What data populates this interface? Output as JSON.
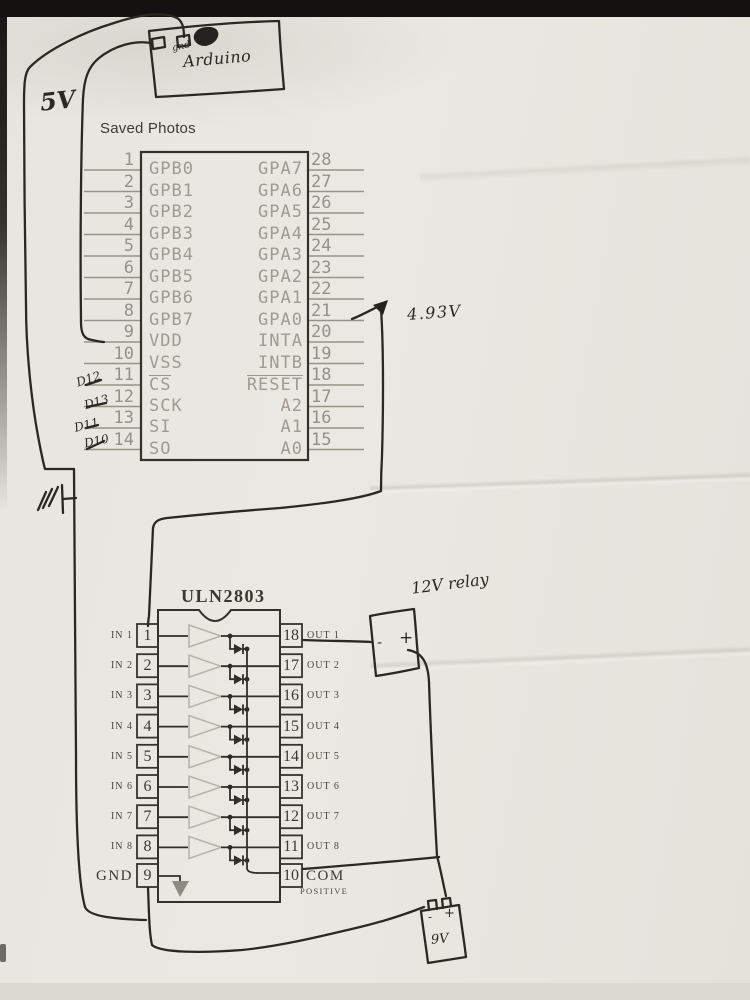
{
  "overlay": {
    "saved_photos": "Saved Photos"
  },
  "handwritten": {
    "supply": "5V",
    "board": "Arduino",
    "board_pin": "gnd",
    "voltage": "4.93V",
    "relay": "12V relay",
    "battery": "9V",
    "relay_minus": "-",
    "relay_plus": "+",
    "battery_minus": "-",
    "battery_plus": "+",
    "dpins": [
      "D12",
      "D13",
      "D11",
      "D10"
    ]
  },
  "mcp": {
    "left_pins": [
      {
        "num": "1",
        "label": "GPB0"
      },
      {
        "num": "2",
        "label": "GPB1"
      },
      {
        "num": "3",
        "label": "GPB2"
      },
      {
        "num": "4",
        "label": "GPB3"
      },
      {
        "num": "5",
        "label": "GPB4"
      },
      {
        "num": "6",
        "label": "GPB5"
      },
      {
        "num": "7",
        "label": "GPB6"
      },
      {
        "num": "8",
        "label": "GPB7"
      },
      {
        "num": "9",
        "label": "VDD"
      },
      {
        "num": "10",
        "label": "VSS"
      },
      {
        "num": "11",
        "label": "CS",
        "overline": true
      },
      {
        "num": "12",
        "label": "SCK"
      },
      {
        "num": "13",
        "label": "SI"
      },
      {
        "num": "14",
        "label": "SO"
      }
    ],
    "right_pins": [
      {
        "num": "28",
        "label": "GPA7"
      },
      {
        "num": "27",
        "label": "GPA6"
      },
      {
        "num": "26",
        "label": "GPA5"
      },
      {
        "num": "25",
        "label": "GPA4"
      },
      {
        "num": "24",
        "label": "GPA3"
      },
      {
        "num": "23",
        "label": "GPA2"
      },
      {
        "num": "22",
        "label": "GPA1"
      },
      {
        "num": "21",
        "label": "GPA0"
      },
      {
        "num": "20",
        "label": "INTA"
      },
      {
        "num": "19",
        "label": "INTB"
      },
      {
        "num": "18",
        "label": "RESET",
        "overline": true
      },
      {
        "num": "17",
        "label": "A2"
      },
      {
        "num": "16",
        "label": "A1"
      },
      {
        "num": "15",
        "label": "A0"
      }
    ]
  },
  "uln": {
    "title": "ULN2803",
    "left_pins": [
      {
        "num": "1",
        "label": "IN 1"
      },
      {
        "num": "2",
        "label": "IN 2"
      },
      {
        "num": "3",
        "label": "IN 3"
      },
      {
        "num": "4",
        "label": "IN 4"
      },
      {
        "num": "5",
        "label": "IN 5"
      },
      {
        "num": "6",
        "label": "IN 6"
      },
      {
        "num": "7",
        "label": "IN 7"
      },
      {
        "num": "8",
        "label": "IN 8"
      },
      {
        "num": "9",
        "label": "GND"
      }
    ],
    "right_pins": [
      {
        "num": "18",
        "label": "OUT 1"
      },
      {
        "num": "17",
        "label": "OUT 2"
      },
      {
        "num": "16",
        "label": "OUT 3"
      },
      {
        "num": "15",
        "label": "OUT 4"
      },
      {
        "num": "14",
        "label": "OUT 5"
      },
      {
        "num": "13",
        "label": "OUT 6"
      },
      {
        "num": "12",
        "label": "OUT 7"
      },
      {
        "num": "11",
        "label": "OUT 8"
      },
      {
        "num": "10",
        "label": "COM",
        "sublabel": "POSITIVE"
      }
    ]
  },
  "colors": {
    "ink": "#2b2823",
    "print_grey": "#9f9b92",
    "print_dark": "#3c3933",
    "paper": "#e9e6e1",
    "scan_bar": "#141110"
  }
}
